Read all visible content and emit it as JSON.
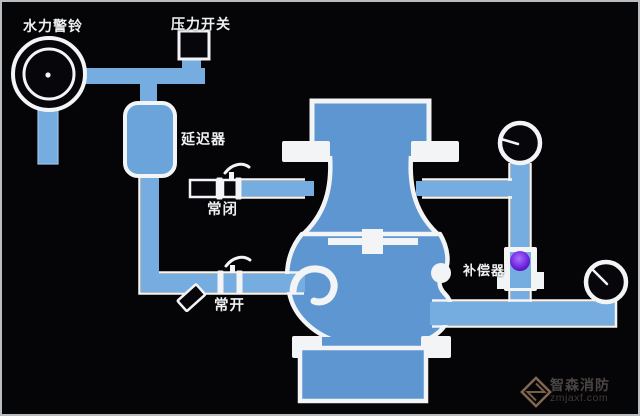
{
  "colors": {
    "background": "#050508",
    "pipe": "#76ade0",
    "valve_body": "#5e96d2",
    "retarder_fill": "#6ba4da",
    "outline": "#f2f4f6",
    "compensator_ball": "#7a2ee8",
    "watermark_text": "#4a4542",
    "watermark_logo": "#96795c"
  },
  "labels": {
    "hydraulic_alarm_bell": "水力警铃",
    "pressure_switch": "压力开关",
    "retarder": "延迟器",
    "normally_closed": "常闭",
    "normally_open": "常开",
    "compensator": "补偿器"
  },
  "watermark": {
    "brand": "智森消防",
    "domain": "zmjaxf.com"
  }
}
